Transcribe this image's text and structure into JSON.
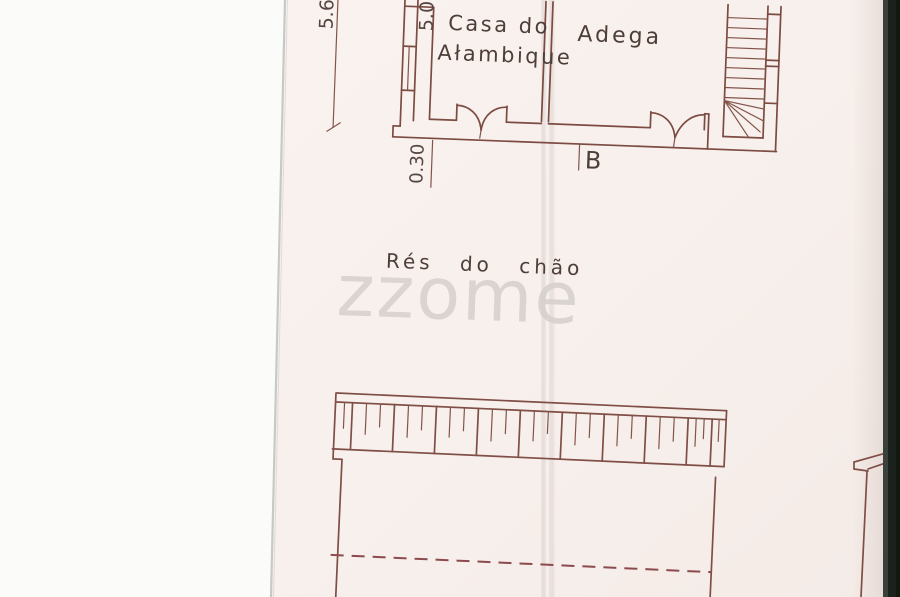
{
  "drawing": {
    "floor_label": "Rés do chão",
    "rooms": {
      "room1_line1": "Casa do",
      "room1_line2": "Ałambique",
      "room2": "Adega"
    },
    "dimensions": {
      "height_total": "5.6",
      "height_inner": "5.0",
      "wall_thickness": "0.30"
    },
    "section_mark": "B"
  },
  "watermark": {
    "text": "zzome"
  },
  "colors": {
    "ink": "#7c4b41",
    "label_ink": "#4e3e38",
    "dashed_line": "#8d4a4e",
    "paper": "#f7efeb",
    "scanner_white": "#fbfbfa",
    "scan_dark_edge": "#1b221d",
    "watermark_gray": "#d4cecb"
  }
}
